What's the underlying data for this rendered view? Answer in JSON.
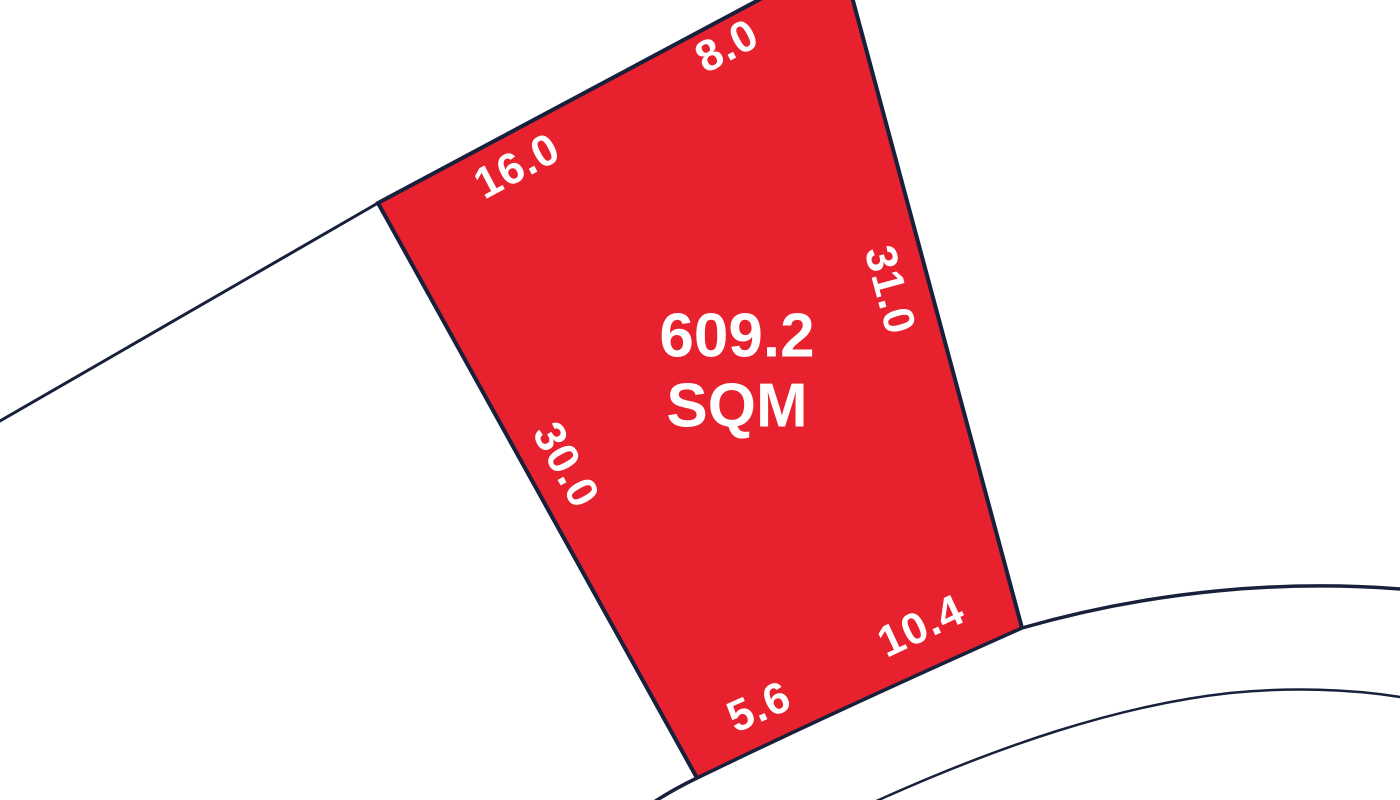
{
  "colors": {
    "lot_fill": "#E8212E",
    "boundary_line": "#17213C",
    "label_text": "#FFFFFF",
    "background": "#FFFFFF"
  },
  "lot": {
    "area_value": "609.2",
    "area_unit": "SQM",
    "dimensions": [
      {
        "side": "top-left-frontage",
        "label": "16.0"
      },
      {
        "side": "top-right-frontage",
        "label": "8.0"
      },
      {
        "side": "right-boundary",
        "label": "31.0"
      },
      {
        "side": "left-boundary",
        "label": "30.0"
      },
      {
        "side": "bottom-left-arc",
        "label": "5.6"
      },
      {
        "side": "bottom-right-arc",
        "label": "10.4"
      }
    ]
  }
}
